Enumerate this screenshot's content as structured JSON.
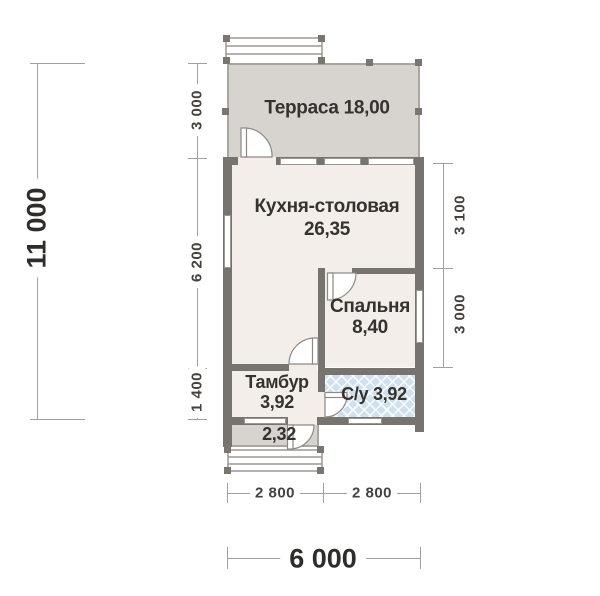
{
  "title": "План дома (поэтажный план)",
  "rooms": {
    "terrace": {
      "name": "Терраса",
      "area": "18,00"
    },
    "kitchen": {
      "name": "Кухня-столовая",
      "area": "26,35"
    },
    "bedroom": {
      "name": "Спальня",
      "area": "8,40"
    },
    "tambour": {
      "name": "Тамбур",
      "area": "3,92"
    },
    "bathroom": {
      "name": "С/у",
      "area": "3,92"
    },
    "porch": {
      "area": "2,32"
    }
  },
  "dimensions": {
    "left_total": "11 000",
    "left_top": "3 000",
    "left_mid": "6 200",
    "left_bottom": "1 400",
    "right_top": "3 100",
    "right_bottom": "3 000",
    "bottom_left": "2 800",
    "bottom_right": "2 800",
    "bottom_total": "6 000"
  },
  "colors": {
    "wall": "#77736e",
    "interior_floor": "#f3eee9",
    "terrace_floor": "#d7d3ce",
    "bathroom_fill": "#cfe1ef",
    "dimension_line": "#a3a09c",
    "text": "#35322f"
  }
}
